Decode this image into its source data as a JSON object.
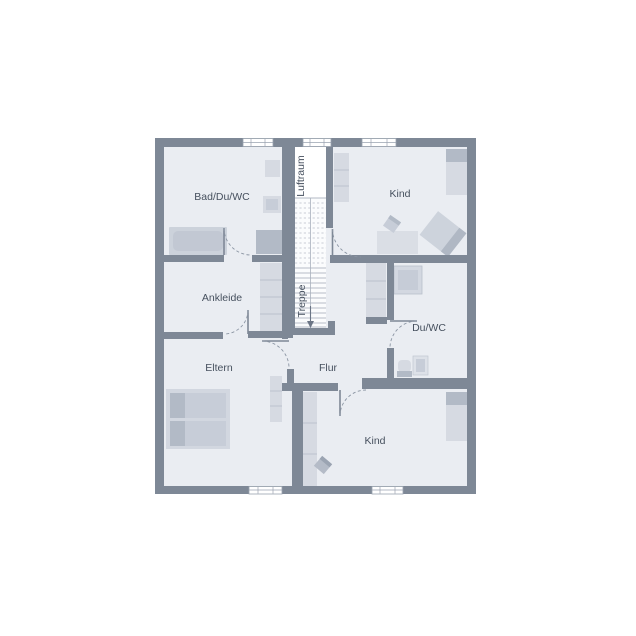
{
  "plan": {
    "rooms": [
      {
        "id": "bad-du-wc",
        "label": "Bad/Du/WC"
      },
      {
        "id": "luftraum",
        "label": "Luftraum"
      },
      {
        "id": "kind-top",
        "label": "Kind"
      },
      {
        "id": "ankleide",
        "label": "Ankleide"
      },
      {
        "id": "treppe",
        "label": "Treppe"
      },
      {
        "id": "du-wc",
        "label": "Du/WC"
      },
      {
        "id": "eltern",
        "label": "Eltern"
      },
      {
        "id": "flur",
        "label": "Flur"
      },
      {
        "id": "kind-bottom",
        "label": "Kind"
      }
    ],
    "colors": {
      "wall": "#7e8896",
      "floor": "#eaedf2",
      "void": "#ffffff",
      "furniture": "#d6dae2",
      "furniture_dark": "#b2bac6",
      "label_text": "#46505e"
    }
  }
}
